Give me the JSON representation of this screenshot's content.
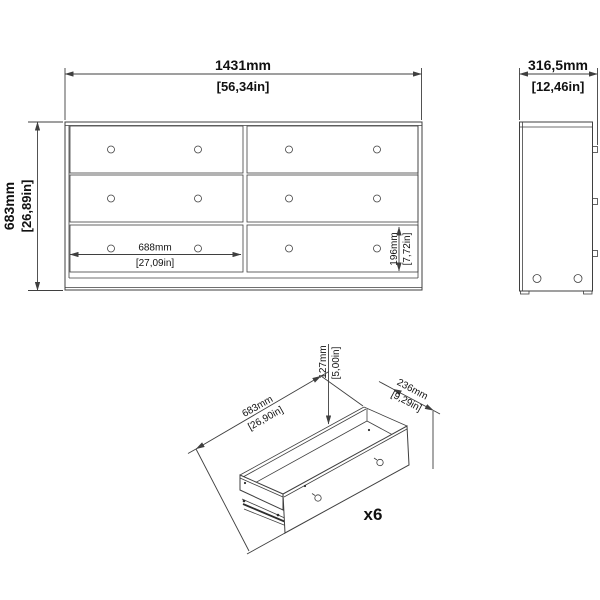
{
  "colors": {
    "line": "#3f3f3f",
    "text": "#111111",
    "background": "#ffffff"
  },
  "front_view": {
    "overall_width_mm": "1431mm",
    "overall_width_in": "[56,34in]",
    "overall_height_mm": "683mm",
    "overall_height_in": "[26,89in]",
    "drawer_width_mm": "688mm",
    "drawer_width_in": "[27,09in]",
    "drawer_height_mm": "196mm",
    "drawer_height_in": "[7,72in]"
  },
  "side_view": {
    "overall_depth_mm": "316,5mm",
    "overall_depth_in": "[12,46in]"
  },
  "drawer_detail": {
    "height_mm": "127mm",
    "height_in": "[5,00in]",
    "width_mm": "683mm",
    "width_in": "[26,90in]",
    "depth_mm": "236mm",
    "depth_in": "[9,29in]",
    "quantity": "x6"
  }
}
